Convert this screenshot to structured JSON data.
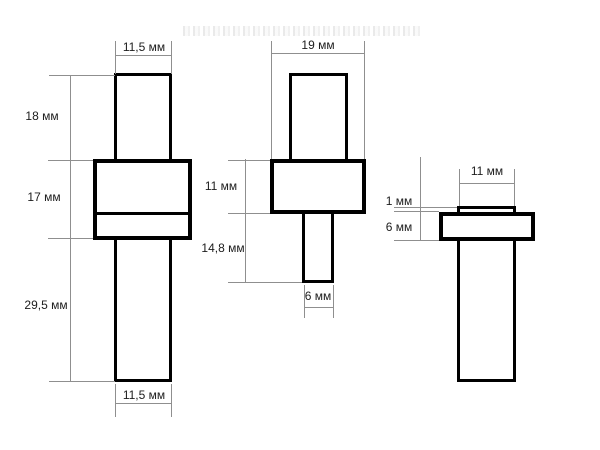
{
  "drawing": {
    "parts": {
      "left": {
        "top_width": "11,5 мм",
        "upper_stem_height": "18 мм",
        "flange_height": "17 мм",
        "lower_stem_height": "29,5 мм",
        "bottom_width": "11,5 мм"
      },
      "middle": {
        "top_width": "19 мм",
        "flange_height": "11 мм",
        "stem_height": "14,8 мм",
        "stem_width": "6 мм"
      },
      "right": {
        "cap_width": "11 мм",
        "cap_height": "1 мм",
        "flange_height": "6 мм"
      }
    }
  }
}
